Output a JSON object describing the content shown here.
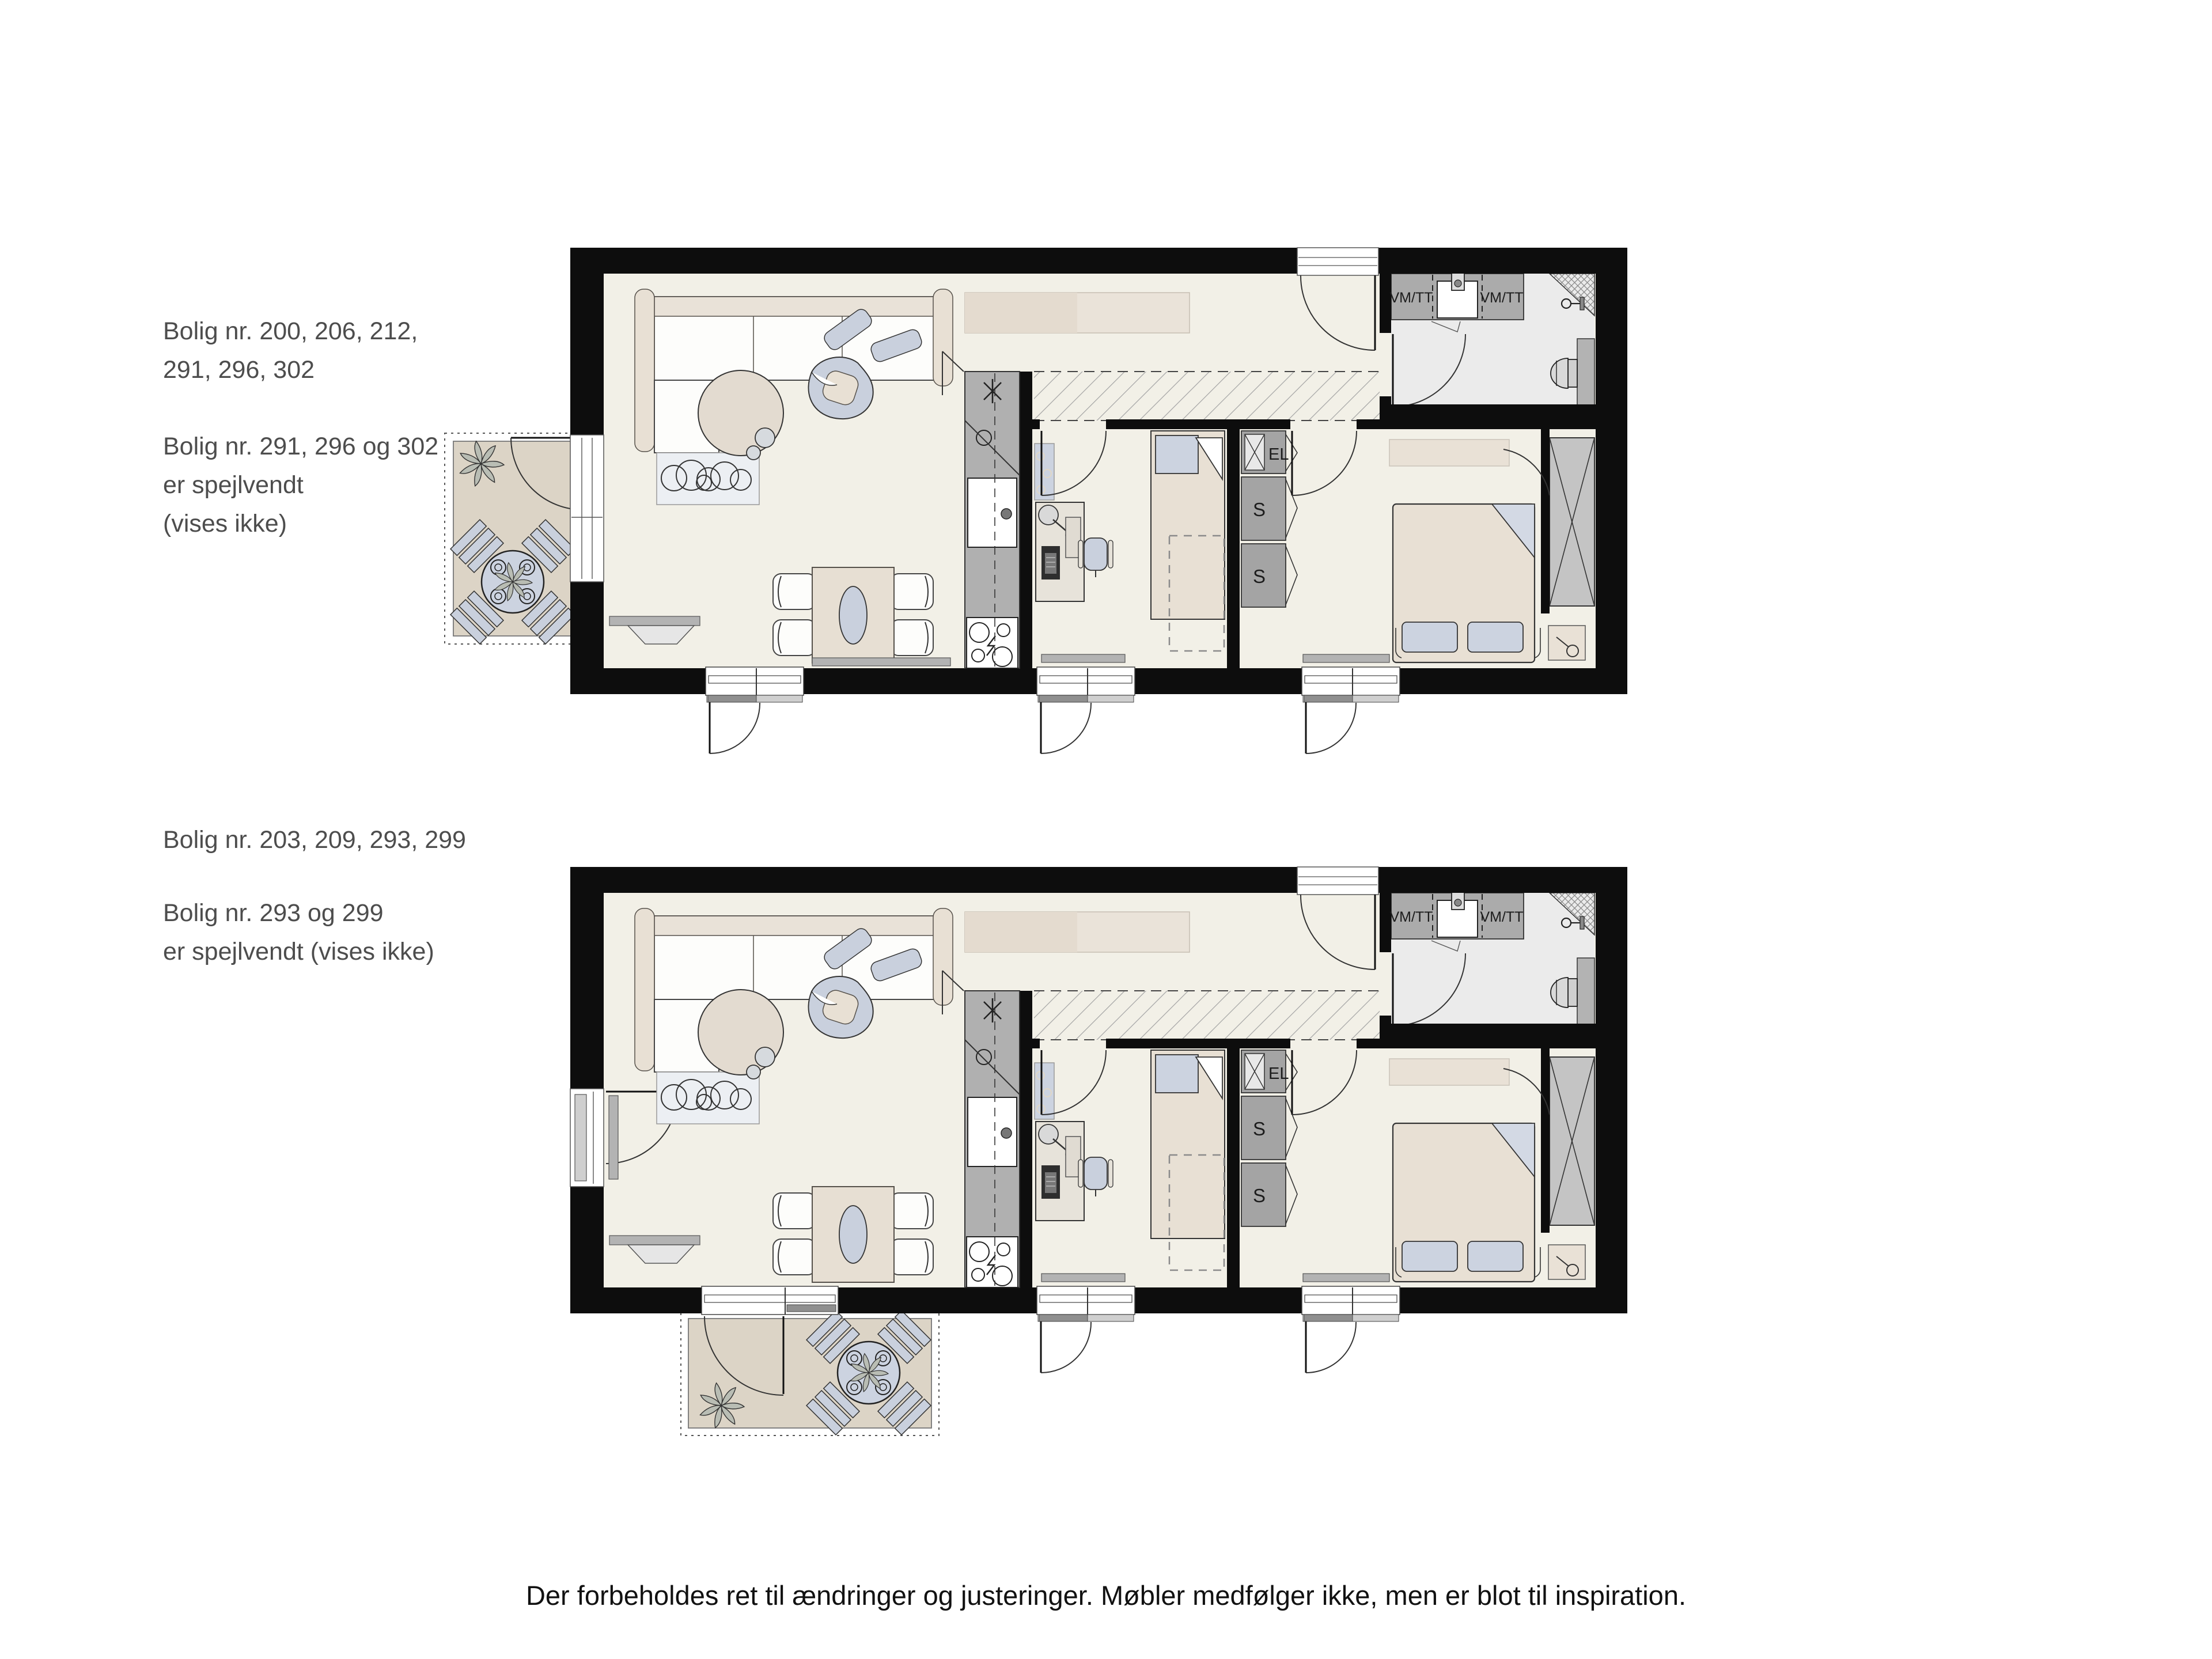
{
  "annotations": {
    "plan1": [
      "Bolig nr. 200, 206, 212,",
      "291, 296, 302"
    ],
    "plan1_mirror": [
      "Bolig nr. 291, 296 og 302",
      "er spejlvendt",
      "(vises ikke)"
    ],
    "plan2": [
      "Bolig nr. 203, 209, 293, 299"
    ],
    "plan2_mirror": [
      "Bolig nr. 293 og 299",
      "er spejlvendt (vises ikke)"
    ],
    "disclaimer": "Der forbeholdes ret til ændringer og justeringer. Møbler medfølger ikke, men er blot til inspiration."
  },
  "plan_labels": {
    "washer_dryer": "VM/TT",
    "electrical": "EL",
    "closet": "S"
  },
  "colors": {
    "wall": "#0d0d0d",
    "floor": "#f2f0e7",
    "bathroom_floor": "#ebebeb",
    "outdoor_deck": "#dcd4c6",
    "furniture_beige": "#e8e0d4",
    "accent_bluegray": "#c9d0dd",
    "cabinet_gray": "#aeaeae",
    "annotation_text": "#4d4d4d"
  }
}
